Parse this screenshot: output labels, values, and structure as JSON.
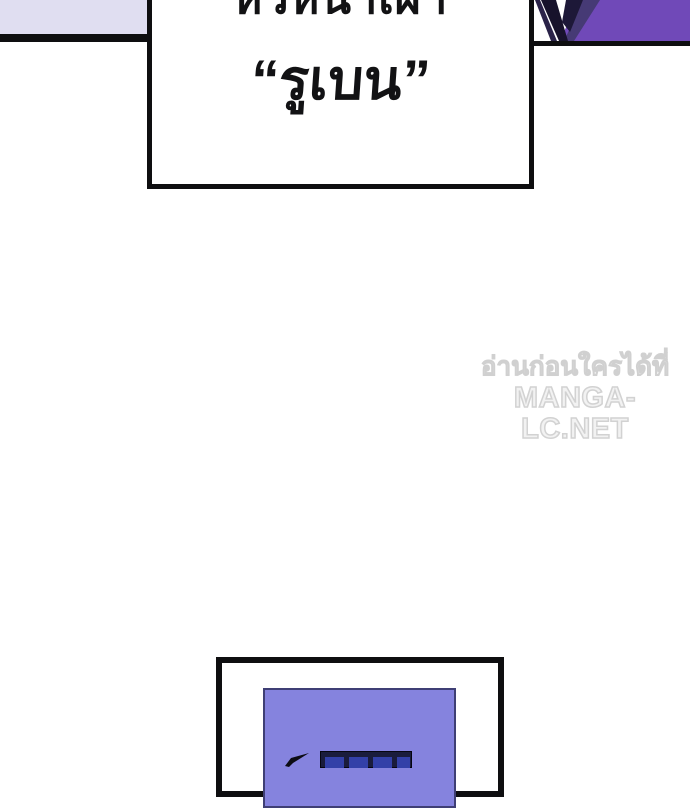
{
  "colors": {
    "lavender-panel": "#e0def1",
    "ink": "#0e0e10",
    "violet-fill": "#7049b8",
    "violet-dark": "#463a75",
    "violet-deep": "#1d1838",
    "near-black": "#17122b",
    "periwinkle": "#8583de",
    "periwinkle-border": "#3f3f75",
    "window-frame": "#1a1c3c",
    "window-pane": "#3340a8",
    "watermark": "#d9d9d9"
  },
  "speech_box": {
    "line1": "หัวหน้าเผ่า",
    "line2": "“รูเบน”"
  },
  "watermark": {
    "line1": "อ่านก่อนใครได้ที่",
    "line2": "MANGA-LC.NET"
  }
}
